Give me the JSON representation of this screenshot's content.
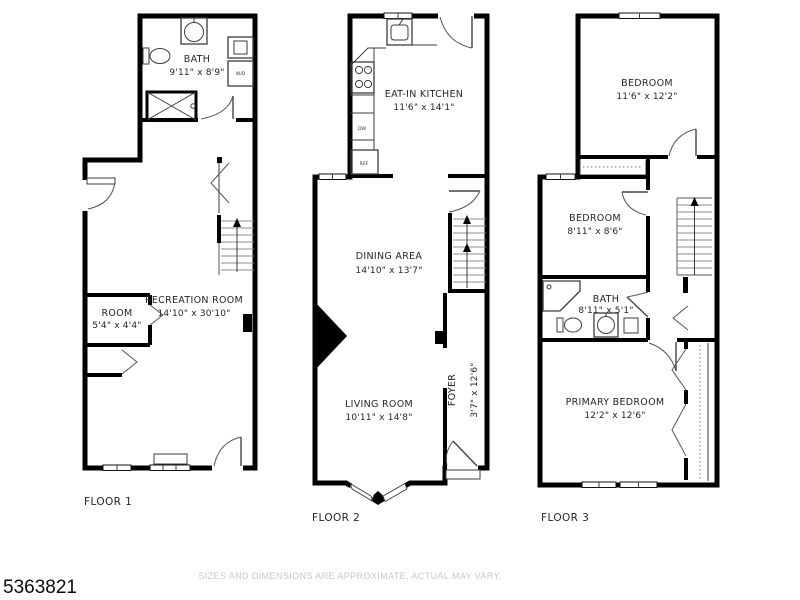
{
  "page": {
    "listing_number": "5363821",
    "disclaimer": "SIZES AND DIMENSIONS ARE APPROXIMATE, ACTUAL MAY VARY.",
    "background": "#ffffff"
  },
  "colors": {
    "wall": "#000000",
    "room_label": "#262626",
    "fixture_line": "#3c3c3c",
    "stair_line": "#8d8d8d",
    "disclaimer_text": "#c8c8c8"
  },
  "floor1": {
    "name": "FLOOR 1",
    "bath": {
      "label": "BATH",
      "dims": "9'11\" x 8'9\""
    },
    "recreation": {
      "label": "RECREATION ROOM",
      "dims": "14'10\" x 30'10\""
    },
    "room": {
      "label": "ROOM",
      "dims": "5'4\" x 4'4\""
    },
    "washer_dryer": "W/D"
  },
  "floor2": {
    "name": "FLOOR 2",
    "kitchen": {
      "label": "EAT-IN KITCHEN",
      "dims": "11'6\" x 14'1\""
    },
    "dining": {
      "label": "DINING AREA",
      "dims": "14'10\" x 13'7\""
    },
    "living": {
      "label": "LIVING ROOM",
      "dims": "10'11\" x 14'8\""
    },
    "foyer": {
      "label": "FOYER",
      "dims": "3'7\" x 12'6\""
    },
    "dishwasher": "DW",
    "refrigerator": "REF"
  },
  "floor3": {
    "name": "FLOOR 3",
    "bedroom1": {
      "label": "BEDROOM",
      "dims": "11'6\" x 12'2\""
    },
    "bedroom2": {
      "label": "BEDROOM",
      "dims": "8'11\" x 8'6\""
    },
    "bath": {
      "label": "BATH",
      "dims": "8'11\" x 5'1\""
    },
    "primary": {
      "label": "PRIMARY BEDROOM",
      "dims": "12'2\" x 12'6\""
    }
  }
}
